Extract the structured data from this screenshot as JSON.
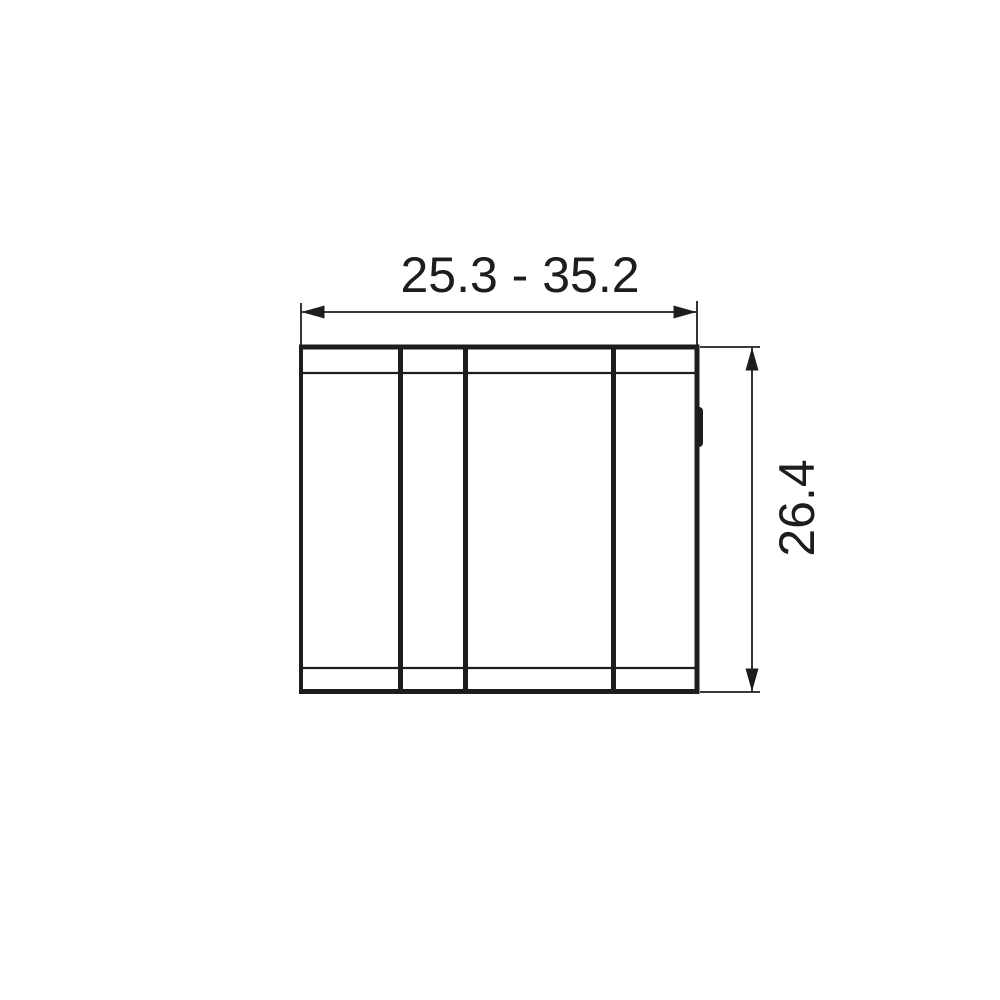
{
  "canvas": {
    "background_color": "#ffffff",
    "ink_color": "#1d1d1b"
  },
  "drawing": {
    "width_dimension": {
      "label": "25.3 - 35.2"
    },
    "height_dimension": {
      "label": "26.4"
    }
  }
}
